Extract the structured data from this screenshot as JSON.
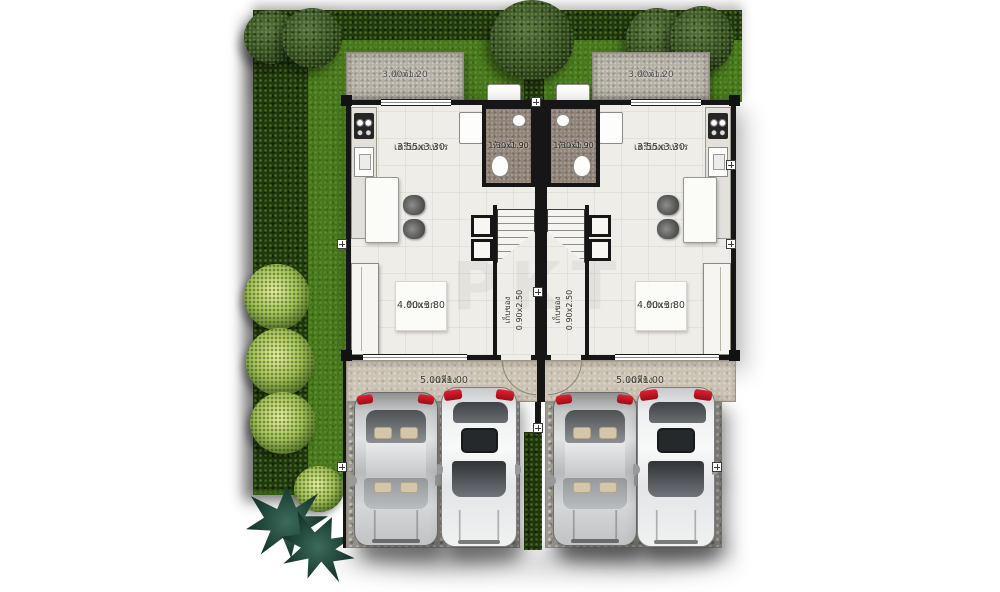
{
  "plan_title": "twin-house-ground-floor-plan",
  "watermark": {
    "text": "PKT"
  },
  "rooms": {
    "laundry": {
      "name": "ซักล้าง",
      "size": "3.00x1.20"
    },
    "kitchen": {
      "name": "เตรียมอาหาร",
      "size": "3.55x3.30"
    },
    "bathroom": {
      "name": "ห้องน้ำ 2",
      "size": "1.30x1.90"
    },
    "living": {
      "name": "รับแขก",
      "size": "4.00x3.80"
    },
    "stair_storage": {
      "name": "เก็บของ",
      "size": "0.90x2.50"
    },
    "porch": {
      "name": "เฉลียง",
      "size": "5.00x1.00"
    }
  },
  "colors": {
    "grass": "#497a1d",
    "hedge": "#20380d",
    "wall": "#161616",
    "patio_concrete": "#b4afa3",
    "porch_floor": "#cbc3b3",
    "driveway_gravel": "#b0aca4",
    "bathroom_floor": "#8f8377",
    "taillight_red": "#c01020"
  }
}
